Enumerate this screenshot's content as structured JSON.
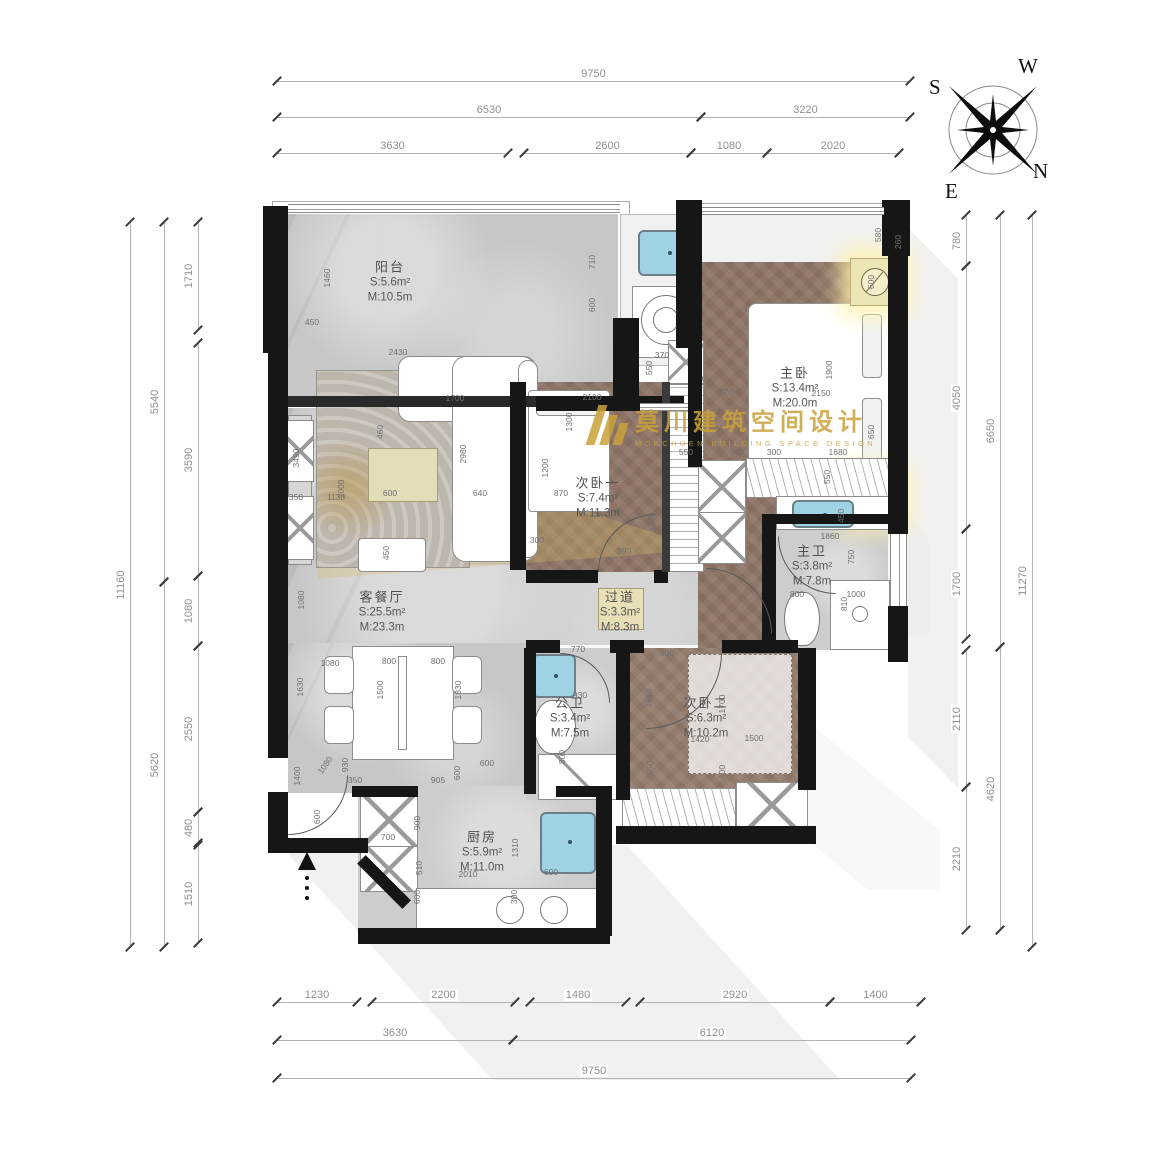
{
  "title": "户型平面布置图",
  "watermark": {
    "cn": "莫川建筑空间设计",
    "en": "MOKCHUEN BUILDING SPACE DESIGN"
  },
  "compass": {
    "w": "W",
    "s": "S",
    "e": "E",
    "n": "N"
  },
  "colors": {
    "wall": "#161616",
    "wood": "#8d7466",
    "marble": "#c7c7c7",
    "gold": "#c9a23a",
    "sink_blue": "#9fd3e3",
    "dim_text": "#8f8f8f"
  },
  "rooms": [
    {
      "name": "阳台",
      "s": "S:5.6m²",
      "m": "M:10.5m"
    },
    {
      "name": "主卧",
      "s": "S:13.4m²",
      "m": "M:20.0m"
    },
    {
      "name": "次卧一",
      "s": "S:7.4m²",
      "m": "M:11.3m"
    },
    {
      "name": "主卫",
      "s": "S:3.8m²",
      "m": "M:7.8m"
    },
    {
      "name": "客餐厅",
      "s": "S:25.5m²",
      "m": "M:23.3m"
    },
    {
      "name": "过道",
      "s": "S:3.3m²",
      "m": "M:8.3m"
    },
    {
      "name": "公卫",
      "s": "S:3.4m²",
      "m": "M:7.5m"
    },
    {
      "name": "次卧二",
      "s": "S:6.3m²",
      "m": "M:10.2m"
    },
    {
      "name": "厨房",
      "s": "S:5.9m²",
      "m": "M:11.0m"
    }
  ],
  "room_label_pos": [
    {
      "x": 390,
      "y": 282
    },
    {
      "x": 795,
      "y": 388
    },
    {
      "x": 598,
      "y": 498
    },
    {
      "x": 812,
      "y": 566
    },
    {
      "x": 382,
      "y": 612
    },
    {
      "x": 620,
      "y": 612
    },
    {
      "x": 570,
      "y": 718
    },
    {
      "x": 706,
      "y": 718
    },
    {
      "x": 482,
      "y": 852
    }
  ],
  "dim_chains": [
    {
      "orient": "h",
      "pos": 81,
      "segments": [
        {
          "label": "9750",
          "a": 277,
          "b": 910
        }
      ]
    },
    {
      "orient": "h",
      "pos": 117,
      "segments": [
        {
          "label": "6530",
          "a": 277,
          "b": 701
        },
        {
          "label": "3220",
          "a": 701,
          "b": 910
        }
      ]
    },
    {
      "orient": "h",
      "pos": 153,
      "segments": [
        {
          "label": "3630",
          "a": 277,
          "b": 508
        },
        {
          "label": "2600",
          "a": 524,
          "b": 691
        },
        {
          "label": "1080",
          "a": 691,
          "b": 767
        },
        {
          "label": "2020",
          "a": 767,
          "b": 899
        }
      ]
    },
    {
      "orient": "h",
      "pos": 1002,
      "segments": [
        {
          "label": "1230",
          "a": 277,
          "b": 357
        },
        {
          "label": "2200",
          "a": 372,
          "b": 515
        },
        {
          "label": "1480",
          "a": 530,
          "b": 626
        },
        {
          "label": "2920",
          "a": 640,
          "b": 830
        },
        {
          "label": "1400",
          "a": 830,
          "b": 921
        }
      ]
    },
    {
      "orient": "h",
      "pos": 1040,
      "segments": [
        {
          "label": "3630",
          "a": 277,
          "b": 513
        },
        {
          "label": "6120",
          "a": 513,
          "b": 911
        }
      ]
    },
    {
      "orient": "h",
      "pos": 1078,
      "segments": [
        {
          "label": "9750",
          "a": 277,
          "b": 911
        }
      ]
    },
    {
      "orient": "v",
      "pos": 198,
      "segments": [
        {
          "label": "1710",
          "a": 222,
          "b": 330
        },
        {
          "label": "3590",
          "a": 343,
          "b": 576
        },
        {
          "label": "1080",
          "a": 576,
          "b": 646
        },
        {
          "label": "2550",
          "a": 646,
          "b": 812
        },
        {
          "label": "480",
          "a": 812,
          "b": 843
        },
        {
          "label": "1510",
          "a": 845,
          "b": 943
        }
      ]
    },
    {
      "orient": "v",
      "pos": 164,
      "segments": [
        {
          "label": "5540",
          "a": 222,
          "b": 582
        },
        {
          "label": "5620",
          "a": 582,
          "b": 947
        }
      ]
    },
    {
      "orient": "v",
      "pos": 130,
      "segments": [
        {
          "label": "11160",
          "a": 222,
          "b": 947
        }
      ]
    },
    {
      "orient": "v",
      "pos": 966,
      "segments": [
        {
          "label": "780",
          "a": 215,
          "b": 266
        },
        {
          "label": "4050",
          "a": 266,
          "b": 529
        },
        {
          "label": "1700",
          "a": 529,
          "b": 639
        },
        {
          "label": "2110",
          "a": 650,
          "b": 787
        },
        {
          "label": "2210",
          "a": 787,
          "b": 930
        }
      ]
    },
    {
      "orient": "v",
      "pos": 1000,
      "segments": [
        {
          "label": "6650",
          "a": 215,
          "b": 647
        },
        {
          "label": "4620",
          "a": 647,
          "b": 930
        }
      ]
    },
    {
      "orient": "v",
      "pos": 1032,
      "segments": [
        {
          "label": "11270",
          "a": 215,
          "b": 947
        }
      ]
    }
  ],
  "inner_dims": [
    {
      "t": "1460",
      "x": 327,
      "y": 278,
      "r": "v"
    },
    {
      "t": "450",
      "x": 312,
      "y": 322,
      "r": "h"
    },
    {
      "t": "2430",
      "x": 398,
      "y": 352,
      "r": "h"
    },
    {
      "t": "710",
      "x": 592,
      "y": 262,
      "r": "v"
    },
    {
      "t": "600",
      "x": 592,
      "y": 305,
      "r": "v"
    },
    {
      "t": "3490",
      "x": 296,
      "y": 458,
      "r": "v"
    },
    {
      "t": "350",
      "x": 296,
      "y": 497,
      "r": "h"
    },
    {
      "t": "1130",
      "x": 336,
      "y": 497,
      "r": "h"
    },
    {
      "t": "600",
      "x": 390,
      "y": 493,
      "r": "h"
    },
    {
      "t": "640",
      "x": 480,
      "y": 493,
      "r": "h"
    },
    {
      "t": "870",
      "x": 561,
      "y": 493,
      "r": "h"
    },
    {
      "t": "1700",
      "x": 455,
      "y": 398,
      "r": "h"
    },
    {
      "t": "460",
      "x": 380,
      "y": 432,
      "r": "v"
    },
    {
      "t": "1000",
      "x": 341,
      "y": 489,
      "r": "v"
    },
    {
      "t": "2980",
      "x": 463,
      "y": 454,
      "r": "v"
    },
    {
      "t": "450",
      "x": 386,
      "y": 553,
      "r": "v"
    },
    {
      "t": "1080",
      "x": 301,
      "y": 600,
      "r": "v"
    },
    {
      "t": "1630",
      "x": 300,
      "y": 687,
      "r": "v"
    },
    {
      "t": "1080",
      "x": 330,
      "y": 663,
      "r": "h"
    },
    {
      "t": "800",
      "x": 389,
      "y": 661,
      "r": "h"
    },
    {
      "t": "800",
      "x": 438,
      "y": 661,
      "r": "h"
    },
    {
      "t": "1500",
      "x": 380,
      "y": 690,
      "r": "v"
    },
    {
      "t": "930",
      "x": 345,
      "y": 765,
      "r": "v"
    },
    {
      "t": "1830",
      "x": 458,
      "y": 690,
      "r": "v"
    },
    {
      "t": "905",
      "x": 438,
      "y": 780,
      "r": "h"
    },
    {
      "t": "350",
      "x": 355,
      "y": 780,
      "r": "h"
    },
    {
      "t": "600",
      "x": 457,
      "y": 773,
      "r": "v"
    },
    {
      "t": "600",
      "x": 487,
      "y": 763,
      "r": "h"
    },
    {
      "t": "1080",
      "x": 325,
      "y": 765,
      "r": "d"
    },
    {
      "t": "1400",
      "x": 297,
      "y": 776,
      "r": "v"
    },
    {
      "t": "600",
      "x": 317,
      "y": 817,
      "r": "v"
    },
    {
      "t": "700",
      "x": 388,
      "y": 837,
      "r": "h"
    },
    {
      "t": "900",
      "x": 417,
      "y": 823,
      "r": "v"
    },
    {
      "t": "510",
      "x": 419,
      "y": 868,
      "r": "v"
    },
    {
      "t": "2010",
      "x": 468,
      "y": 874,
      "r": "h"
    },
    {
      "t": "1310",
      "x": 515,
      "y": 848,
      "r": "v"
    },
    {
      "t": "600",
      "x": 551,
      "y": 872,
      "r": "h"
    },
    {
      "t": "300",
      "x": 514,
      "y": 897,
      "r": "v"
    },
    {
      "t": "600",
      "x": 417,
      "y": 897,
      "r": "v"
    },
    {
      "t": "2100",
      "x": 592,
      "y": 397,
      "r": "h"
    },
    {
      "t": "1300",
      "x": 569,
      "y": 422,
      "r": "v"
    },
    {
      "t": "1200",
      "x": 545,
      "y": 468,
      "r": "v"
    },
    {
      "t": "890",
      "x": 624,
      "y": 551,
      "r": "h"
    },
    {
      "t": "1400",
      "x": 652,
      "y": 522,
      "r": "v"
    },
    {
      "t": "300",
      "x": 537,
      "y": 540,
      "r": "h"
    },
    {
      "t": "550",
      "x": 686,
      "y": 452,
      "r": "h"
    },
    {
      "t": "370",
      "x": 662,
      "y": 355,
      "r": "h"
    },
    {
      "t": "550",
      "x": 649,
      "y": 368,
      "r": "v"
    },
    {
      "t": "580",
      "x": 878,
      "y": 235,
      "r": "v"
    },
    {
      "t": "260",
      "x": 898,
      "y": 242,
      "r": "v"
    },
    {
      "t": "600",
      "x": 871,
      "y": 282,
      "r": "v"
    },
    {
      "t": "1900",
      "x": 829,
      "y": 370,
      "r": "v"
    },
    {
      "t": "2150",
      "x": 821,
      "y": 393,
      "r": "h"
    },
    {
      "t": "770",
      "x": 726,
      "y": 392,
      "r": "h"
    },
    {
      "t": "940",
      "x": 737,
      "y": 452,
      "r": "h"
    },
    {
      "t": "300",
      "x": 774,
      "y": 452,
      "r": "h"
    },
    {
      "t": "1680",
      "x": 838,
      "y": 452,
      "r": "h"
    },
    {
      "t": "650",
      "x": 871,
      "y": 432,
      "r": "v"
    },
    {
      "t": "1860",
      "x": 830,
      "y": 536,
      "r": "h"
    },
    {
      "t": "750",
      "x": 851,
      "y": 557,
      "r": "v"
    },
    {
      "t": "800",
      "x": 797,
      "y": 594,
      "r": "h"
    },
    {
      "t": "1000",
      "x": 856,
      "y": 594,
      "r": "h"
    },
    {
      "t": "810",
      "x": 844,
      "y": 604,
      "r": "v"
    },
    {
      "t": "450",
      "x": 841,
      "y": 516,
      "r": "v"
    },
    {
      "t": "550",
      "x": 827,
      "y": 477,
      "r": "v"
    },
    {
      "t": "770",
      "x": 578,
      "y": 649,
      "r": "h"
    },
    {
      "t": "900",
      "x": 667,
      "y": 653,
      "r": "h"
    },
    {
      "t": "930",
      "x": 580,
      "y": 695,
      "r": "h"
    },
    {
      "t": "800",
      "x": 562,
      "y": 757,
      "r": "v"
    },
    {
      "t": "1660",
      "x": 649,
      "y": 698,
      "r": "v"
    },
    {
      "t": "1700",
      "x": 722,
      "y": 704,
      "r": "v"
    },
    {
      "t": "1500",
      "x": 754,
      "y": 738,
      "r": "h"
    },
    {
      "t": "1420",
      "x": 700,
      "y": 739,
      "r": "h"
    },
    {
      "t": "550",
      "x": 650,
      "y": 768,
      "r": "v"
    },
    {
      "t": "400",
      "x": 722,
      "y": 772,
      "r": "v"
    }
  ]
}
